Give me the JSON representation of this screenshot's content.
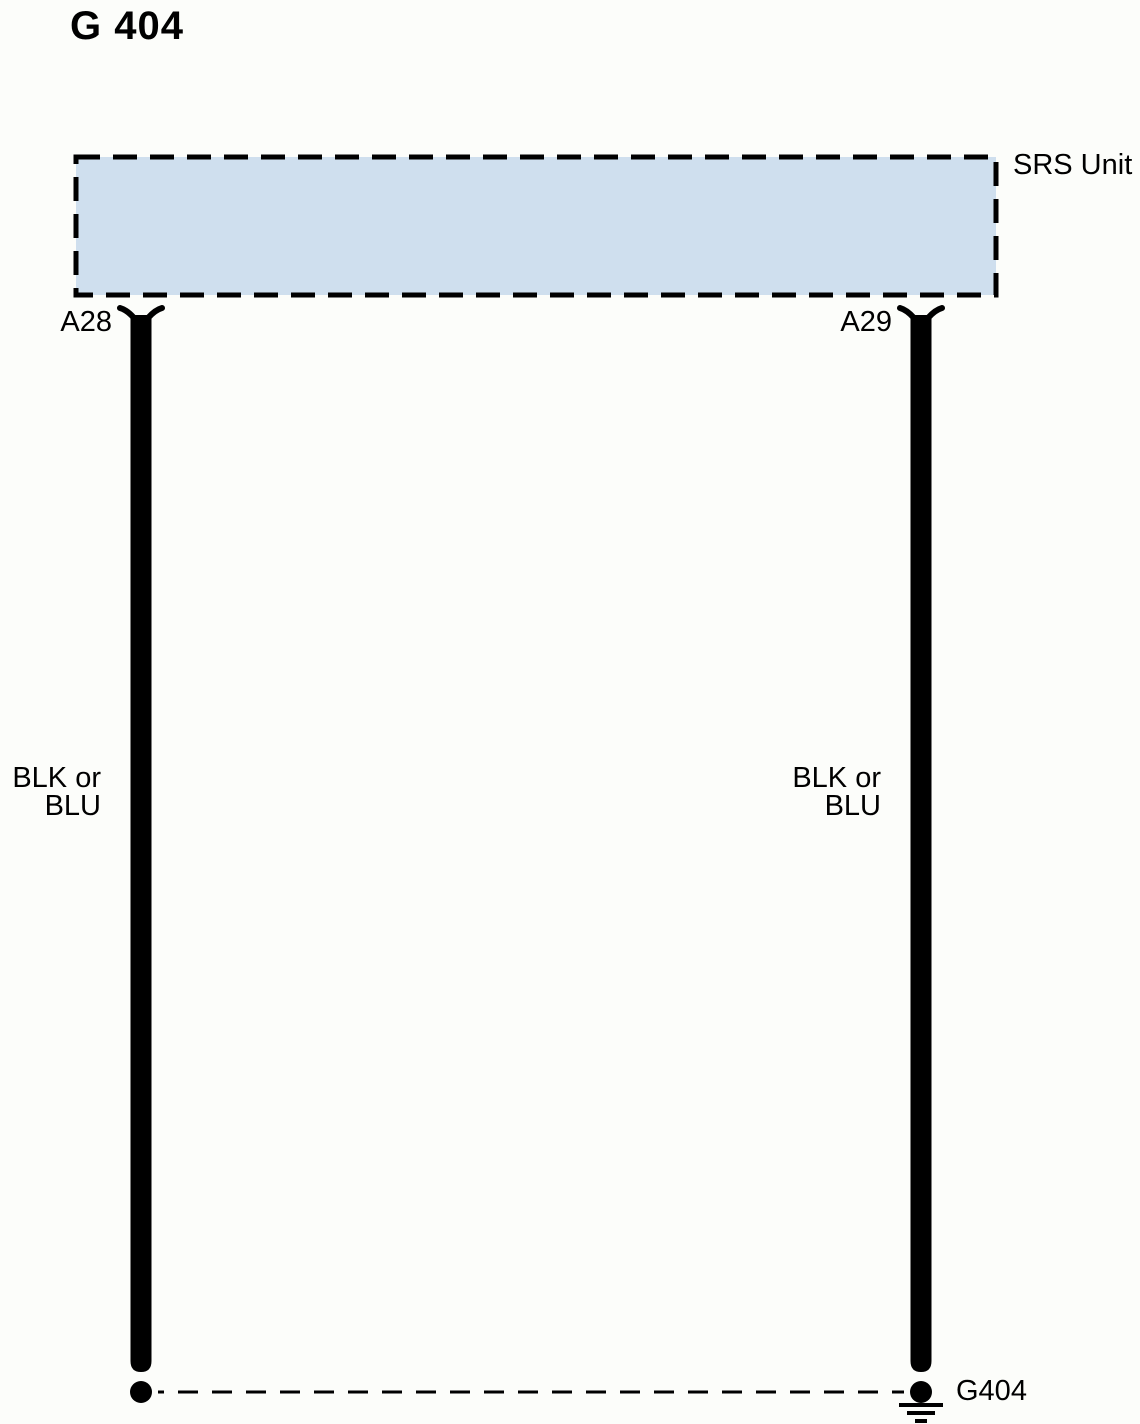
{
  "title": "G 404",
  "component": {
    "label": "SRS Unit"
  },
  "pins": [
    {
      "id": "A28"
    },
    {
      "id": "A29"
    }
  ],
  "wires": [
    {
      "pin": "A28",
      "color": "BLK or\nBLU"
    },
    {
      "pin": "A29",
      "color": "BLK or\nBLU"
    }
  ],
  "ground": {
    "id": "G404"
  },
  "colors": {
    "component_fill": "#cfdfee",
    "line": "#000000"
  }
}
